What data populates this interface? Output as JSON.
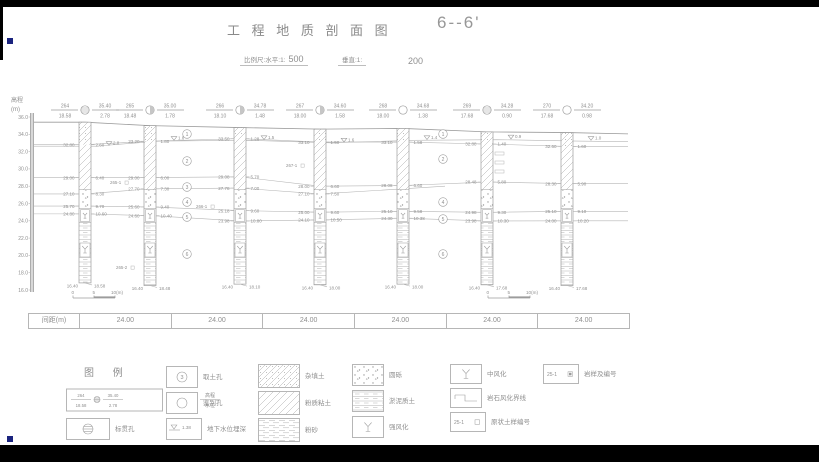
{
  "page": {
    "bg": "#ffffff",
    "bar": "#000000",
    "line": "#b6b6b6",
    "dark_line": "#9c9c9c",
    "text": "#8f8f8f",
    "marker": "#1a237e"
  },
  "header": {
    "title": "工 程 地 质 剖 面 图",
    "section_label": "6--6'",
    "scale_label_h": "比例尺:水平:1:",
    "scale_h": "500",
    "scale_label_v": "垂直:1:",
    "scale_v": "200"
  },
  "axis": {
    "label": "高程",
    "unit": "(m)",
    "step_px": 17.3,
    "ticks": [
      "36.0",
      "34.0",
      "32.0",
      "30.0",
      "28.0",
      "26.0",
      "24.0",
      "22.0",
      "20.0",
      "18.0",
      "16.0"
    ]
  },
  "boreholes": [
    {
      "no": "264",
      "x": 85,
      "elev": "35.40",
      "depth": "18.58",
      "water": "2.78",
      "sym": "hatched",
      "bottom_elev": "16.40",
      "anns": [
        [
          "32.80",
          "2.60"
        ],
        [
          "29.00",
          "6.40"
        ],
        [
          "27.10",
          "8.30"
        ],
        [
          "25.70",
          "9.70"
        ],
        [
          "24.80",
          "10.60"
        ]
      ]
    },
    {
      "no": "265",
      "x": 150,
      "elev": "35.00",
      "depth": "18.48",
      "water": "1.78",
      "sym": "half",
      "bottom_elev": "16.40",
      "anns": [
        [
          "33.20",
          "1.80"
        ],
        [
          "29.00",
          "6.00"
        ],
        [
          "27.70",
          "7.30"
        ],
        [
          "25.60",
          "9.40"
        ],
        [
          "24.60",
          "10.40"
        ]
      ]
    },
    {
      "no": "266",
      "x": 240,
      "elev": "34.78",
      "depth": "18.10",
      "water": "1.48",
      "sym": "half",
      "bottom_elev": "16.40",
      "anns": [
        [
          "33.50",
          "1.28"
        ],
        [
          "29.08",
          "5.70"
        ],
        [
          "27.78",
          "7.00"
        ],
        [
          "25.18",
          "9.60"
        ],
        [
          "23.98",
          "10.80"
        ]
      ]
    },
    {
      "no": "267",
      "x": 320,
      "elev": "34.60",
      "depth": "18.00",
      "water": "1.58",
      "sym": "half",
      "bottom_elev": "16.40",
      "anns": [
        [
          "33.10",
          "1.50"
        ],
        [
          "28.00",
          "6.60"
        ],
        [
          "27.10",
          "7.50"
        ],
        [
          "25.00",
          "9.60"
        ],
        [
          "24.10",
          "10.50"
        ]
      ]
    },
    {
      "no": "268",
      "x": 403,
      "elev": "34.68",
      "depth": "18.00",
      "water": "1.38",
      "sym": "open",
      "bottom_elev": "16.40",
      "anns": [
        [
          "33.10",
          "1.58"
        ],
        [
          "28.08",
          "6.60"
        ],
        null,
        [
          "25.10",
          "9.58"
        ],
        [
          "24.30",
          "10.38"
        ]
      ]
    },
    {
      "no": "269",
      "x": 487,
      "elev": "34.28",
      "depth": "17.68",
      "water": "0.90",
      "sym": "hatched",
      "bottom_elev": "16.40",
      "bars": [
        152,
        161,
        170
      ],
      "anns": [
        [
          "32.88",
          "1.40"
        ],
        [
          "28.48",
          "5.80"
        ],
        null,
        [
          "24.98",
          "9.30"
        ],
        [
          "23.98",
          "10.30"
        ]
      ]
    },
    {
      "no": "270",
      "x": 567,
      "elev": "34.20",
      "depth": "17.68",
      "water": "0.98",
      "sym": "open",
      "bottom_elev": "16.40",
      "anns": [
        [
          "32.60",
          "1.60"
        ],
        [
          "28.30",
          "5.90"
        ],
        null,
        [
          "25.10",
          "9.10"
        ],
        [
          "24.00",
          "10.20"
        ]
      ]
    }
  ],
  "layer_marks": {
    "left": {
      "x": 187,
      "items": [
        [
          "1",
          134
        ],
        [
          "2",
          161
        ],
        [
          "3",
          187
        ],
        [
          "4",
          202
        ],
        [
          "5",
          217
        ],
        [
          "6",
          254
        ]
      ]
    },
    "right": {
      "x": 443,
      "items": [
        [
          "1",
          134
        ],
        [
          "2",
          159
        ],
        [
          "4",
          202
        ],
        [
          "5",
          219
        ],
        [
          "6",
          254
        ]
      ]
    }
  },
  "samples": [
    {
      "label": "265-1",
      "x": 110,
      "y": 182
    },
    {
      "label": "266-1",
      "x": 196,
      "y": 206
    },
    {
      "label": "265-2",
      "x": 116,
      "y": 267
    },
    {
      "label": "267-1",
      "x": 286,
      "y": 165
    }
  ],
  "scalebars": [
    {
      "x": 73,
      "y": 298,
      "labels": [
        "0",
        "5",
        "10(m)"
      ]
    },
    {
      "x": 488,
      "y": 298,
      "labels": [
        "0",
        "5",
        "10(m)"
      ]
    }
  ],
  "spacing_table": {
    "label": "间距(m)",
    "values": [
      "24.00",
      "24.00",
      "24.00",
      "24.00",
      "24.00",
      "24.00"
    ]
  },
  "legend": {
    "title": "图 例",
    "key": {
      "no": "264",
      "elev": "35.40",
      "depth": "18.58",
      "water": "2.78",
      "label_no": "孔号",
      "label_elev": "高程",
      "label_depth": "孔深",
      "label_water": "水位"
    },
    "items": [
      {
        "sym": "spt-circle",
        "label": "标贯孔",
        "x": 66,
        "y": 418,
        "w": 42,
        "h": 20
      },
      {
        "sym": "circled-3",
        "label": "取土孔",
        "tag": "3",
        "x": 166,
        "y": 366,
        "w": 30,
        "h": 20
      },
      {
        "sym": "open-circle",
        "label": "鉴别孔",
        "x": 166,
        "y": 392,
        "w": 30,
        "h": 20
      },
      {
        "sym": "water-mark",
        "label": "地下水位埋深",
        "tag": "1.38",
        "x": 166,
        "y": 418,
        "w": 34,
        "h": 20
      },
      {
        "sym": "fill-hatch",
        "label": "杂填土",
        "x": 258,
        "y": 364,
        "w": 40,
        "h": 22
      },
      {
        "sym": "clay-hatch",
        "label": "粉质粘土",
        "x": 258,
        "y": 391,
        "w": 40,
        "h": 22
      },
      {
        "sym": "sand-dash",
        "label": "粉砂",
        "x": 258,
        "y": 418,
        "w": 40,
        "h": 22
      },
      {
        "sym": "gravel-dots",
        "label": "圆砾",
        "x": 352,
        "y": 364,
        "w": 30,
        "h": 20
      },
      {
        "sym": "muck-lines",
        "label": "淤泥质土",
        "x": 352,
        "y": 390,
        "w": 30,
        "h": 20
      },
      {
        "sym": "psi",
        "label": "强风化",
        "x": 352,
        "y": 416,
        "w": 30,
        "h": 20
      },
      {
        "sym": "psi",
        "label": "中风化",
        "x": 450,
        "y": 364,
        "w": 30,
        "h": 18
      },
      {
        "sym": "weathering-line",
        "label": "岩石风化界线",
        "x": 450,
        "y": 388,
        "w": 30,
        "h": 18
      },
      {
        "sym": "sample-tag",
        "label": "原状土样编号",
        "tag": "25-1",
        "x": 450,
        "y": 412,
        "w": 34,
        "h": 18
      },
      {
        "sym": "rock-sample-tag",
        "label": "岩样及编号",
        "tag": "25-1",
        "x": 543,
        "y": 364,
        "w": 34,
        "h": 18
      }
    ]
  },
  "markers": [
    {
      "x": 7,
      "y": 38
    },
    {
      "x": 7,
      "y": 436
    }
  ]
}
